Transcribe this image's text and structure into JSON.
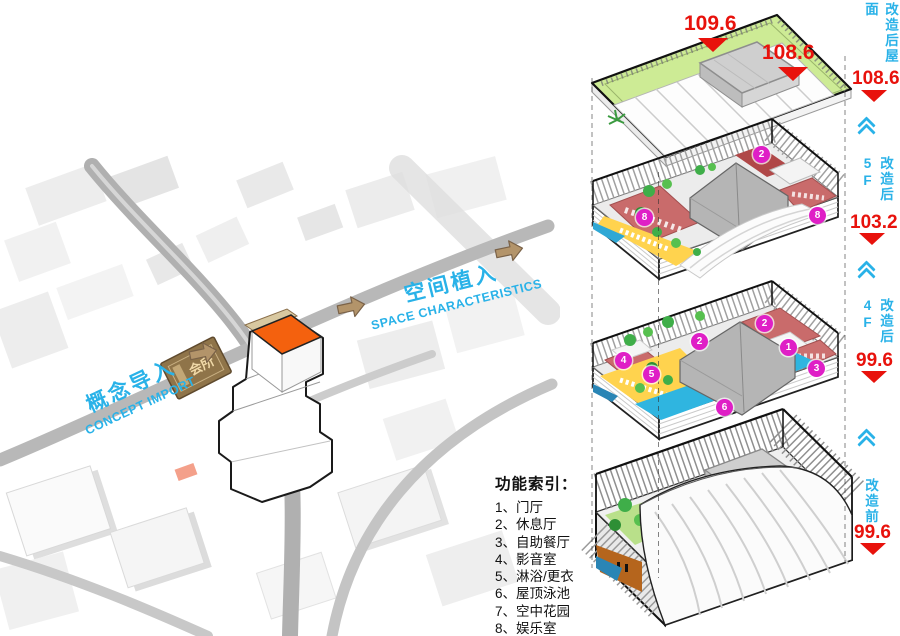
{
  "map": {
    "concept_zh": "概念导入",
    "concept_en": "CONCEPT IMPORT",
    "space_zh": "空间植入",
    "space_en": "SPACE CHARACTERISTICS",
    "plaque_text": "会所"
  },
  "legend": {
    "title": "功能索引：",
    "items": [
      "1、门厅",
      "2、休息厅",
      "3、自助餐厅",
      "4、影音室",
      "5、淋浴/更衣",
      "6、屋顶泳池",
      "7、空中花园",
      "8、娱乐室"
    ]
  },
  "elevations": {
    "top": [
      {
        "value": "109.6"
      },
      {
        "value": "108.6"
      }
    ],
    "side": [
      {
        "label": "改造后屋面",
        "value": "108.6"
      },
      {
        "label": "改造后5F",
        "value": "103.2"
      },
      {
        "label": "改造后4F",
        "value": "99.6"
      },
      {
        "label": "改造前",
        "value": "99.6"
      }
    ]
  },
  "markers": {
    "f5": [
      "8",
      "2",
      "8"
    ],
    "f4": [
      "4",
      "5",
      "2",
      "2",
      "1",
      "3",
      "6"
    ]
  },
  "colors": {
    "cyan": "#29b2e8",
    "red": "#e8120c",
    "magenta": "#df1fc6",
    "roof_green": "#cdeb95",
    "pool_blue": "#2fb5e0",
    "deck_yellow": "#ffd34e",
    "room_pink": "#c96b6b",
    "tree_green": "#3fae49",
    "arrow_tan": "#b3946a",
    "tower_orange": "#f4610e"
  }
}
